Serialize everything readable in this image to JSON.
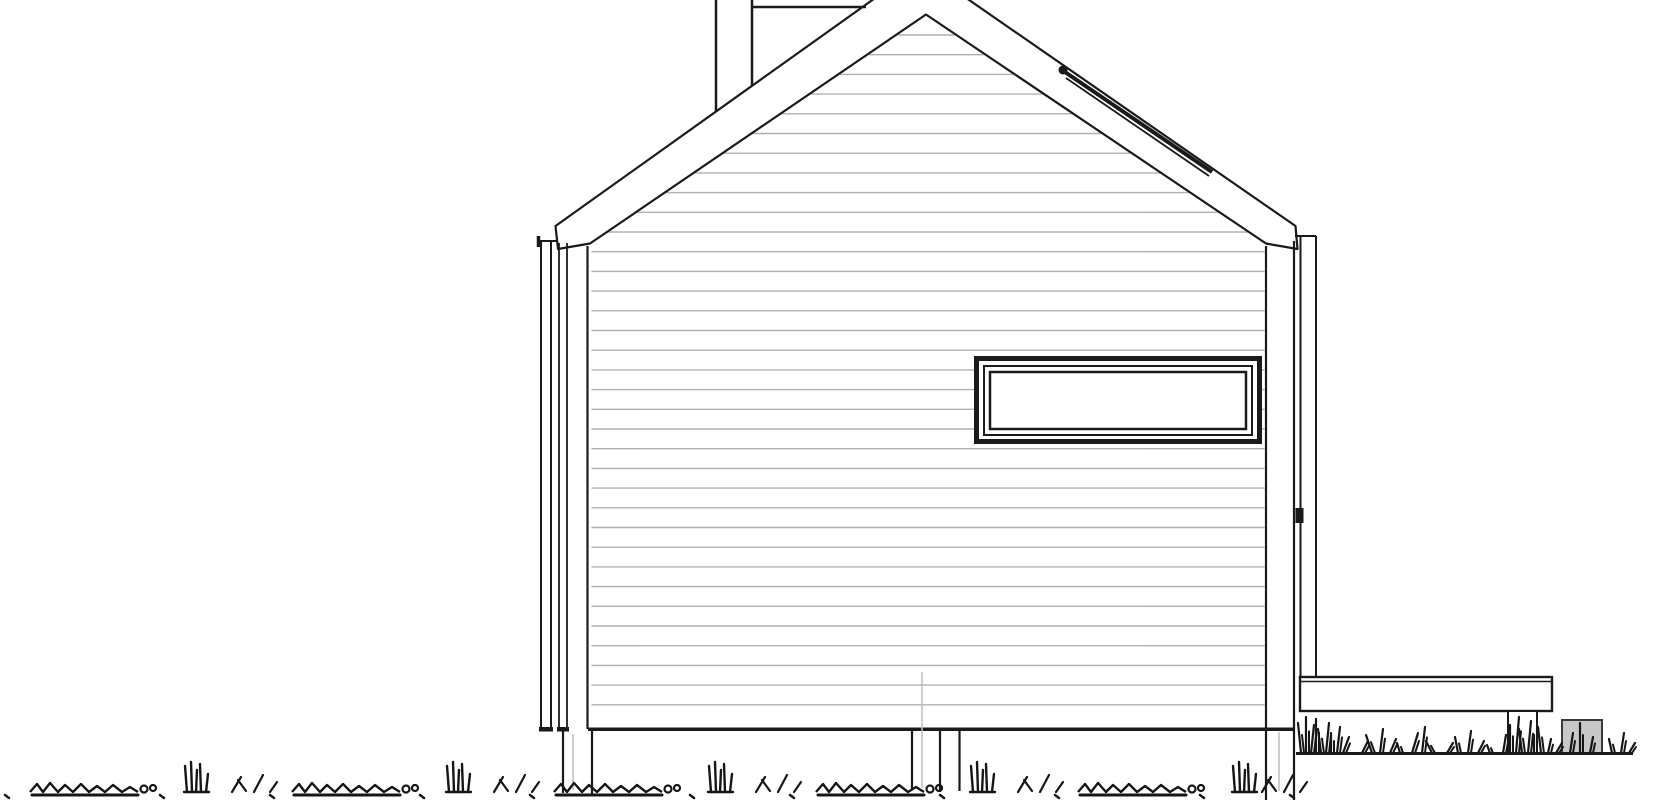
{
  "meta": {
    "title": "Architectural elevation drawing of a gable-roof house with deck",
    "background": "#ffffff"
  },
  "colors": {
    "line": "#1a1a1a",
    "line_medium": "#3a3a3a",
    "siding": "#b0b0b0",
    "faint": "#bdbdbd",
    "concrete_fill": "#c8c8c8",
    "paper": "#ffffff",
    "grass": "#161616"
  },
  "drawing": {
    "canvas": {
      "width": 1670,
      "height": 800
    },
    "siding": {
      "apex": [
        926,
        16
      ],
      "slope_left": 1.4802,
      "slope_right": 1.4978,
      "eave_y": 243,
      "wall_left": 591,
      "wall_right": 1265,
      "first_y": 35,
      "last_y": 714,
      "spacing": 19.7,
      "width": 1.4
    },
    "lawn": {
      "baseline": 792,
      "mound_path": "M0,0 l7,-8 l6,8 l7,-9 l8,9 l7,-7 l8,7 l8,-8 l8,8 l8,-6 l8,6 l8,-7 l9,7 l8,-5 l8,5",
      "mound_underline": 106,
      "mound_circles": [
        [
          114,
          -3,
          3.5
        ],
        [
          123,
          -4,
          3
        ]
      ],
      "vtuft_blades": [
        [
          0,
          0,
          -2,
          -26
        ],
        [
          5,
          0,
          4,
          -30
        ],
        [
          9,
          0,
          10,
          -22
        ],
        [
          14,
          0,
          13,
          -28
        ],
        [
          19,
          0,
          21,
          -18
        ],
        [
          -3,
          0,
          22,
          0
        ]
      ],
      "slant_blades": [
        [
          0,
          0,
          9,
          -15
        ],
        [
          14,
          -1,
          6,
          -12
        ],
        [
          22,
          0,
          31,
          -17
        ],
        [
          38,
          0,
          45,
          -10
        ]
      ],
      "mounds_x": [
        30,
        292,
        554,
        816,
        1078
      ],
      "vtufts_x": [
        187,
        449,
        711,
        973,
        1235
      ],
      "slants_x": [
        232,
        494,
        756,
        1018,
        1262
      ],
      "dots_x": [
        5,
        160,
        270,
        420,
        530,
        690,
        790,
        940,
        1055,
        1200,
        1290
      ]
    },
    "right_grass": {
      "baseline": 753,
      "tufts": [
        [
          1301,
          30,
          -1
        ],
        [
          1306,
          36,
          0
        ],
        [
          1311,
          28,
          1
        ],
        [
          1316,
          34,
          0
        ],
        [
          1321,
          24,
          -1
        ],
        [
          1326,
          30,
          1
        ],
        [
          1331,
          20,
          0
        ],
        [
          1337,
          26,
          1
        ],
        [
          1343,
          16,
          2
        ],
        [
          1362,
          12,
          2
        ],
        [
          1372,
          18,
          -2
        ],
        [
          1380,
          24,
          1
        ],
        [
          1390,
          14,
          2
        ],
        [
          1400,
          10,
          -1
        ],
        [
          1412,
          20,
          2
        ],
        [
          1422,
          26,
          1
        ],
        [
          1432,
          12,
          -2
        ],
        [
          1447,
          10,
          2
        ],
        [
          1458,
          16,
          -1
        ],
        [
          1468,
          22,
          1
        ],
        [
          1478,
          12,
          2
        ],
        [
          1490,
          8,
          -1
        ],
        [
          1503,
          18,
          1
        ],
        [
          1510,
          28,
          0
        ],
        [
          1516,
          36,
          1
        ],
        [
          1522,
          24,
          -1
        ],
        [
          1528,
          32,
          1
        ],
        [
          1534,
          18,
          0
        ],
        [
          1541,
          26,
          -1
        ],
        [
          1548,
          14,
          1
        ],
        [
          1556,
          10,
          2
        ],
        [
          1570,
          20,
          1
        ],
        [
          1580,
          30,
          0
        ],
        [
          1590,
          16,
          1
        ],
        [
          1612,
          14,
          -1
        ],
        [
          1621,
          20,
          1
        ],
        [
          1629,
          10,
          2
        ]
      ]
    },
    "shapes": [
      {
        "n": "gable-wall",
        "t": "polygon",
        "pts": "590,246 926,16 1266,246 1266,729 590,729",
        "f": "#ffffff"
      },
      {
        "n": "siding-lines",
        "t": "siding"
      },
      {
        "n": "window-outer-frame",
        "t": "rect",
        "x": 976.5,
        "y": 358.5,
        "wd": 283,
        "h": 83,
        "f": "#ffffff",
        "s": "#1a1a1a",
        "w": 5
      },
      {
        "n": "window-middle-frame",
        "t": "rect",
        "x": 984,
        "y": 366,
        "wd": 268,
        "h": 69,
        "f": "#ffffff",
        "s": "#1a1a1a",
        "w": 2
      },
      {
        "n": "window-inner-frame",
        "t": "rect",
        "x": 990,
        "y": 372,
        "wd": 256,
        "h": 57,
        "f": "#ffffff",
        "s": "#1a1a1a",
        "w": 2.5
      },
      {
        "n": "roof-band",
        "t": "polygon",
        "pts": "558,249 555.5,226 920,-34 1295.5,226 1297.5,249 1266,243.5 926,14.5 590,243.5",
        "f": "#ffffff",
        "s": "#1a1a1a",
        "w": 2.2
      },
      {
        "n": "chimney-left-edge",
        "t": "line",
        "p": [
          716,
          0,
          716,
          112
        ],
        "w": 2.5
      },
      {
        "n": "chimney-right-edge",
        "t": "line",
        "p": [
          752,
          0,
          752,
          86
        ],
        "w": 2.5
      },
      {
        "n": "ridge-extension-line",
        "t": "line",
        "p": [
          753,
          7,
          866,
          7
        ],
        "w": 2.5
      },
      {
        "n": "skylight-strip",
        "t": "line",
        "p": [
          1062,
          70,
          1212,
          172
        ],
        "w": 4
      },
      {
        "n": "skylight-strip-lower-line",
        "t": "line",
        "p": [
          1066,
          78,
          1209,
          176
        ],
        "w": 1.8
      },
      {
        "n": "skylight-end-cap",
        "t": "circle",
        "cx": 1063,
        "cy": 70,
        "r": 4.5,
        "f": "#1a1a1a"
      },
      {
        "n": "left-downspout-outer-edge",
        "t": "line",
        "p": [
          541,
          240,
          541,
          729
        ],
        "w": 2
      },
      {
        "n": "left-downspout-inner-edge",
        "t": "line",
        "p": [
          551,
          240,
          551,
          729
        ],
        "w": 2
      },
      {
        "n": "left-downspout-elbow",
        "t": "line",
        "p": [
          538.5,
          236,
          538.5,
          247
        ],
        "w": 3.5
      },
      {
        "n": "left-downspout-elbow-arm",
        "t": "line",
        "p": [
          539,
          241,
          557,
          241
        ],
        "w": 2
      },
      {
        "n": "left-corner-trim-line-a",
        "t": "line",
        "p": [
          559,
          243,
          559,
          729
        ],
        "w": 1.8
      },
      {
        "n": "left-corner-trim-line-b",
        "t": "line",
        "p": [
          567,
          243,
          567,
          729
        ],
        "w": 1.8
      },
      {
        "n": "wall-left-edge",
        "t": "line",
        "p": [
          587.5,
          246,
          587.5,
          729
        ],
        "w": 2.2
      },
      {
        "n": "wall-right-edge",
        "t": "line",
        "p": [
          1266,
          246,
          1266,
          800
        ],
        "w": 2.2
      },
      {
        "n": "right-corner-trim-outer-edge",
        "t": "line",
        "p": [
          1294,
          241,
          1294,
          800
        ],
        "w": 2.2
      },
      {
        "n": "right-downspout-outer-edge",
        "t": "line",
        "p": [
          1300.5,
          236,
          1300.5,
          677
        ],
        "w": 2
      },
      {
        "n": "right-downspout-inner-edge",
        "t": "line",
        "p": [
          1316,
          236,
          1316,
          677
        ],
        "w": 2
      },
      {
        "n": "right-downspout-elbow-arm",
        "t": "line",
        "p": [
          1295,
          236,
          1316,
          236
        ],
        "w": 2
      },
      {
        "n": "right-downspout-bracket",
        "t": "rect",
        "x": 1295.5,
        "y": 508,
        "wd": 8,
        "h": 15,
        "f": "#1a1a1a"
      },
      {
        "n": "wall-base-band",
        "t": "rect",
        "x": 588,
        "y": 727.5,
        "wd": 707,
        "h": 3.5,
        "f": "#1a1a1a"
      },
      {
        "n": "left-trim-bottom-cap-a",
        "t": "rect",
        "x": 539,
        "y": 727,
        "wd": 14,
        "h": 4.5,
        "f": "#1a1a1a"
      },
      {
        "n": "left-trim-bottom-cap-b",
        "t": "rect",
        "x": 557,
        "y": 727,
        "wd": 12,
        "h": 4.5,
        "f": "#1a1a1a"
      },
      {
        "n": "foundation-post-left-edge-a",
        "t": "line",
        "p": [
          563,
          731,
          563,
          793
        ],
        "w": 2.2
      },
      {
        "n": "foundation-post-left-edge-b",
        "t": "line",
        "p": [
          592,
          731,
          592,
          795
        ],
        "w": 2.2
      },
      {
        "n": "foundation-post-center-edge-a",
        "t": "line",
        "p": [
          912,
          731,
          912,
          790
        ],
        "w": 2.2
      },
      {
        "n": "foundation-post-center-edge-b",
        "t": "line",
        "p": [
          940,
          731,
          940,
          792
        ],
        "w": 2.2
      },
      {
        "n": "foundation-post-center-edge-c",
        "t": "line",
        "p": [
          959.5,
          731,
          959.5,
          791
        ],
        "w": 2.2
      },
      {
        "n": "pier-centerline-left",
        "t": "line",
        "p": [
          573,
          734,
          573,
          790
        ],
        "w": 1.5,
        "s": "#bdbdbd"
      },
      {
        "n": "section-guideline-center",
        "t": "line",
        "p": [
          922,
          672,
          922,
          788
        ],
        "w": 1.5,
        "s": "#bdbdbd"
      },
      {
        "n": "pier-centerline-right",
        "t": "line",
        "p": [
          1279,
          732,
          1279,
          791
        ],
        "w": 1.5,
        "s": "#bdbdbd"
      },
      {
        "n": "deck-band",
        "t": "rect",
        "x": 1300,
        "y": 677,
        "wd": 252,
        "h": 34,
        "f": "#ffffff",
        "s": "#1a1a1a",
        "w": 2.4
      },
      {
        "n": "deck-surface-inner-line",
        "t": "line",
        "p": [
          1301,
          681.5,
          1551,
          681.5
        ],
        "w": 1.5
      },
      {
        "n": "deck-support-post",
        "t": "rect",
        "x": 1508,
        "y": 711,
        "wd": 29,
        "h": 42,
        "f": "#ffffff",
        "s": "#1a1a1a",
        "w": 2
      },
      {
        "n": "concrete-pad",
        "t": "rect",
        "x": 1562,
        "y": 720,
        "wd": 40,
        "h": 33,
        "f": "#c8c8c8",
        "s": "#3a3a3a",
        "w": 2
      },
      {
        "n": "ground-line-right",
        "t": "line",
        "p": [
          1296,
          753.5,
          1633,
          753.5
        ],
        "w": 3
      },
      {
        "n": "right-grass",
        "t": "rgrass"
      },
      {
        "n": "left-lawn-grass",
        "t": "lawn"
      }
    ]
  }
}
